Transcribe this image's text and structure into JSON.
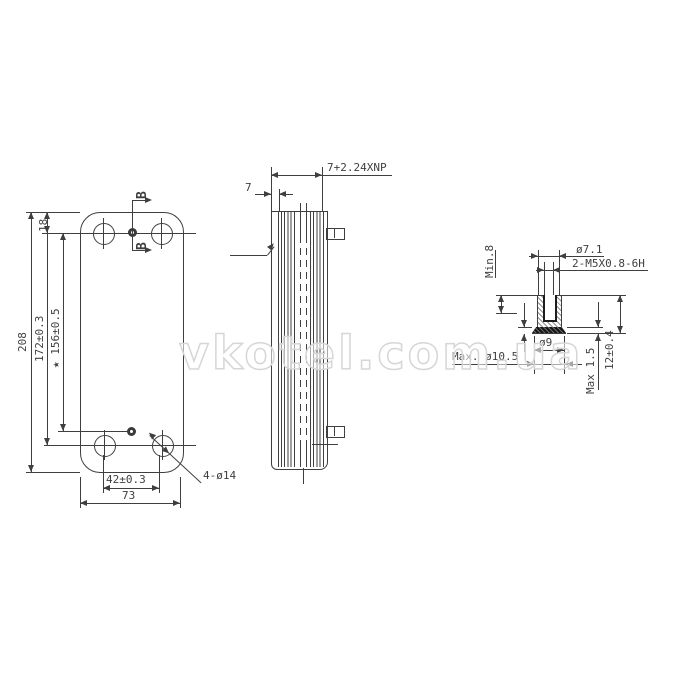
{
  "watermark": {
    "text": "vkotel.com.ua"
  },
  "front_view": {
    "section_marker_top": "B",
    "section_marker_bottom": "B",
    "dim_total_height": "208",
    "dim_top_offset": "18",
    "dim_port_centers": "172±0.3",
    "dim_stud_centers": "★ 156±0.5",
    "dim_hole_spacing": "42±0.3",
    "dim_total_width": "73",
    "hole_callout": "4-ø14"
  },
  "side_view": {
    "dim_end_plate": "7",
    "dim_stack_formula": "7+2.24XNP"
  },
  "detail_view": {
    "dim_boss_diameter": "ø7.1",
    "thread_callout": "2-M5X0.8-6H",
    "dim_thread_depth": "Min.8",
    "dim_flange_diameter": "ø9",
    "dim_max_flange_diameter": "Max. ø10.5",
    "dim_flange_thickness": "Max 1.5",
    "dim_boss_length": "12±0.4"
  },
  "colors": {
    "line": "#3f3f3f",
    "watermark_outline": "#d6d6d6"
  }
}
